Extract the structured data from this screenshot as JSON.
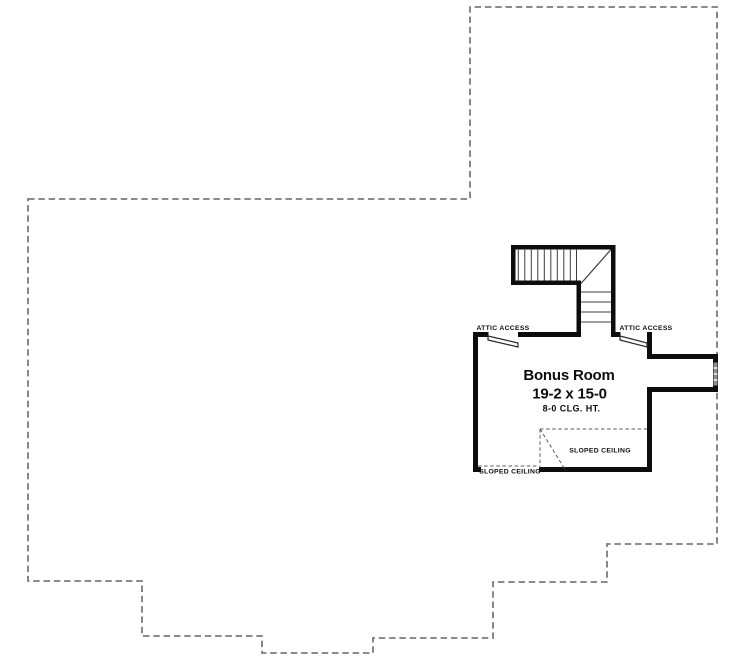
{
  "plan": {
    "title": "Upper level floor plan",
    "room": {
      "name": "Bonus Room",
      "dimensions": "19-2 x 15-0",
      "ceiling_height": "8-0 CLG. HT."
    },
    "labels": {
      "attic_access_left": "ATTIC ACCESS",
      "attic_access_right": "ATTIC ACCESS",
      "sloped_ceiling_center": "SLOPED CEILING",
      "sloped_ceiling_bottom": "SLOPED CEILING"
    },
    "colors": {
      "background": "#ffffff",
      "wall": "#0d0d0d",
      "roof_outline_dashed": "#7b7b7b",
      "stair_tread": "#3d3d3d",
      "sloped_ceiling_dashed": "#5a5a5a",
      "window_glass": "#8f8f8f",
      "text": "#0d0d0d"
    }
  }
}
